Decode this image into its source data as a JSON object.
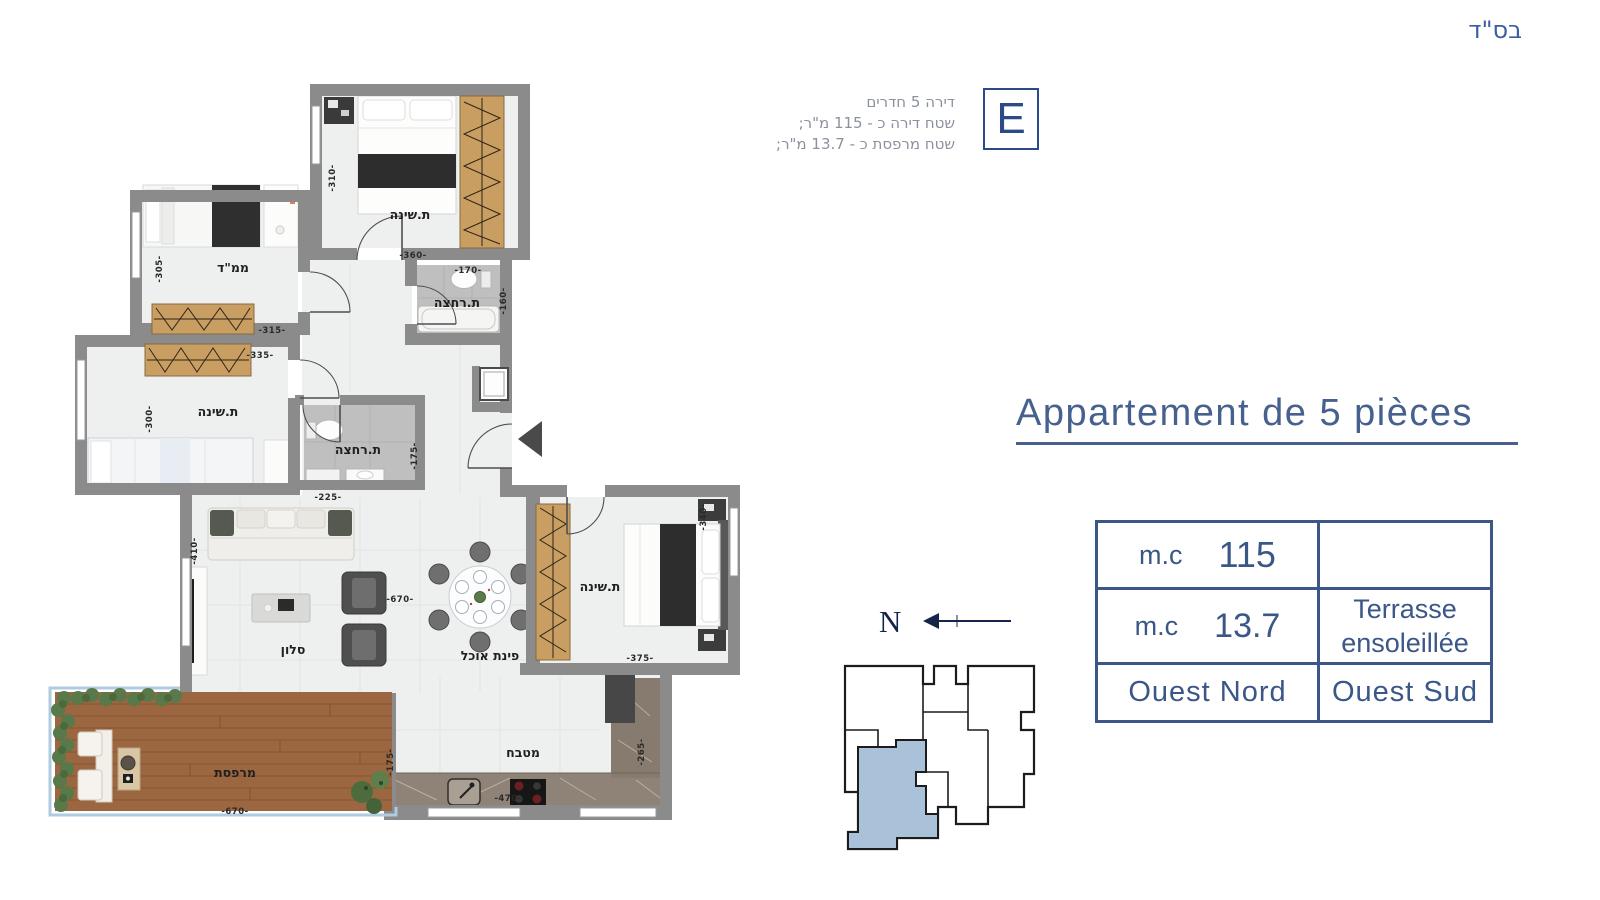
{
  "header": {
    "bsd": "בס\"ד"
  },
  "unit_info": {
    "letter": "E",
    "lines": [
      "דירה 5 חדרים",
      "שטח דירה כ - 115 מ\"ר;",
      "שטח מרפסת כ - 13.7 מ\"ר;"
    ]
  },
  "title": {
    "text": "Appartement de 5 pièces"
  },
  "spec_table": {
    "rows": [
      {
        "left_unit": "m.c",
        "left_value": "115",
        "right_line1": "",
        "right_line2": ""
      },
      {
        "left_unit": "m.c",
        "left_value": "13.7",
        "right_line1": "Terrasse",
        "right_line2": "ensoleillée"
      },
      {
        "left_text": "Ouest Nord",
        "right_text": "Ouest Sud"
      }
    ]
  },
  "compass": {
    "north_label": "N"
  },
  "plan": {
    "rooms": {
      "bedroom_top": "ת.שינה",
      "mamad": "ממ\"ד",
      "bath_top": "ת.רחצה",
      "bedroom_left": "ת.שינה",
      "bath_mid": "ת.רחצה",
      "salon": "סלון",
      "dining": "פינת אוכל",
      "bedroom_right": "ת.שינה",
      "kitchen": "מטבח",
      "terrace": "מרפסת"
    },
    "dims": {
      "bedroom_top_v": "-310-",
      "bedroom_top_h": "-360-",
      "bath_top_h": "-170-",
      "bath_top_v": "-160-",
      "mamad_v": "-305-",
      "mamad_h": "-315-",
      "bedroom_left_h": "-335-",
      "bedroom_left_v": "-300-",
      "bath_mid_h": "-225-",
      "bath_mid_v": "-175-",
      "salon_v": "-410-",
      "salon_h": "-670-",
      "bedroom_right_v": "-340-",
      "bedroom_right_h": "-375-",
      "kitchen_v": "-265-",
      "kitchen_h": "-470-",
      "terrace_h": "-670-",
      "terrace_v": "-175-"
    }
  },
  "colors": {
    "accent_blue": "#3a5787",
    "title_blue": "#47618f",
    "keyplan_highlight": "#a9c2d9",
    "wall_gray": "#8b8b8b"
  }
}
